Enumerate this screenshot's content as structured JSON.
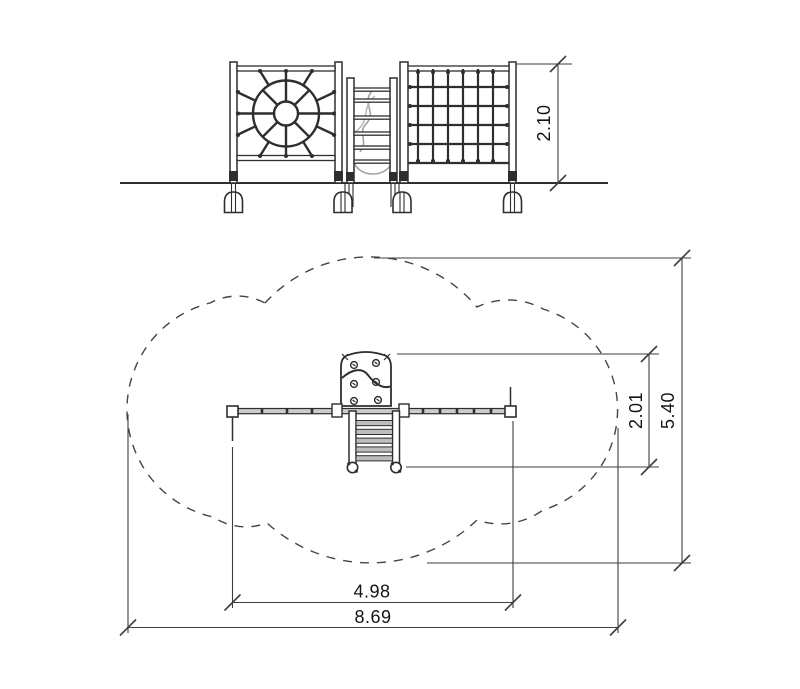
{
  "drawing": {
    "dimensions": {
      "elevation_height": "2.10",
      "plan_equipment_depth": "2.01",
      "plan_safety_zone_depth": "5.40",
      "plan_equipment_width": "4.98",
      "plan_safety_zone_width": "8.69"
    },
    "colors": {
      "line": "#2e2e2e",
      "dimension_line": "#3e3e3e",
      "text": "#141414",
      "rope_light": "#a3a3a3",
      "rail_fill": "#cccccc",
      "rung_fill": "#bdbdbd",
      "background": "#ffffff"
    }
  }
}
